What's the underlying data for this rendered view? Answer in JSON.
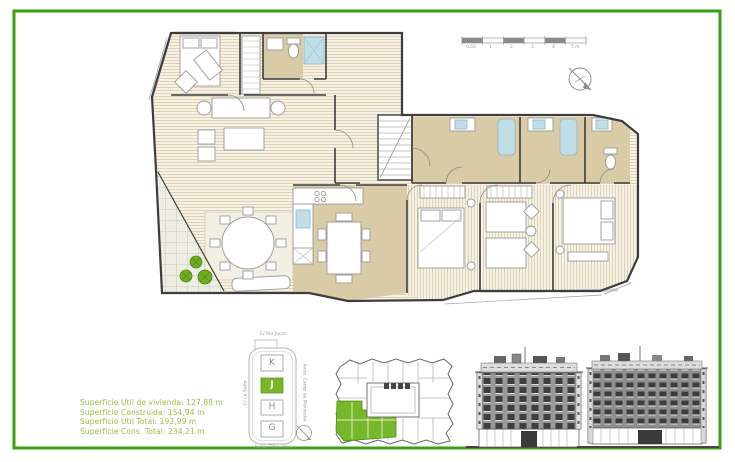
{
  "frame": {
    "border_color": "#3aa00f"
  },
  "summary": {
    "lines": [
      "Superficie Util de vivienda: 127,88 m",
      "Superficie Construida: 154,94 m",
      "Superficie Util Total: 192,99 m",
      "Superficie Cons. Total: 234,21 m"
    ],
    "text_color": "#93c13e"
  },
  "keyplan": {
    "streets": {
      "top": "C/ Río Jucar",
      "left": "C/ La Safor",
      "right": "Avda. Camp de Morvedre",
      "bottom": "Avda. Tibesetles"
    },
    "units": [
      "K",
      "J",
      "H",
      "G"
    ],
    "highlighted_unit": "J",
    "highlight_color": "#76b82a"
  },
  "scalebar": {
    "ticks": [
      "0.50",
      "1",
      "2",
      "3",
      "4",
      "5 m"
    ]
  },
  "plan_colors": {
    "wood_floor": "#f7f2e4",
    "wet_rooms": "#d9cba6",
    "fixtures_blue": "#bfdee8",
    "walls": "#3d3d3d",
    "plants": "#6fae1f"
  }
}
